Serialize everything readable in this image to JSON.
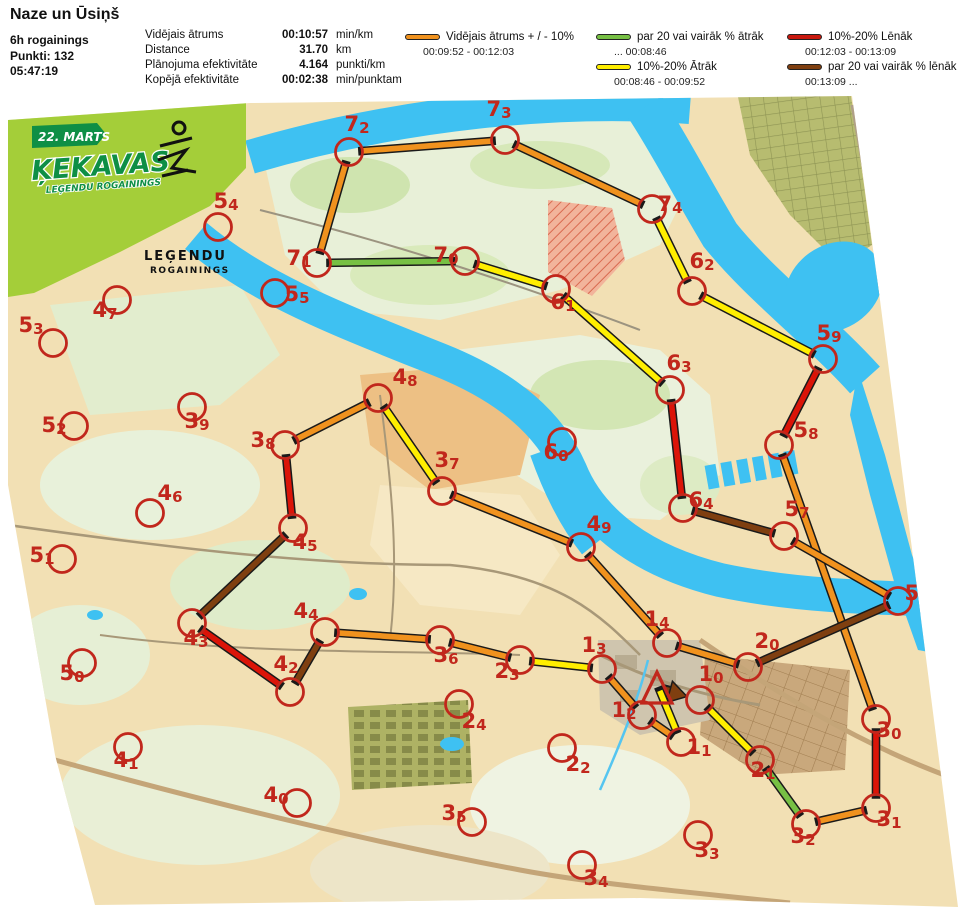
{
  "header": {
    "title": "Naze un Ūsiņš",
    "event": "6h rogainings",
    "points": "Punkti: 132",
    "time": "05:47:19",
    "stats": [
      {
        "label": "Vidējais ātrums",
        "value": "00:10:57",
        "unit": "min/km"
      },
      {
        "label": "Distance",
        "value": "31.70",
        "unit": "km"
      },
      {
        "label": "Plānojuma efektivitāte",
        "value": "4.164",
        "unit": "punkti/km"
      },
      {
        "label": "Kopējā efektivitāte",
        "value": "00:02:38",
        "unit": "min/punktam"
      }
    ]
  },
  "legend": {
    "items": [
      {
        "id": "avg",
        "label": "Vidējais ātrums + / - 10%",
        "range": "00:09:52   -   00:12:03",
        "color": "#F0921E"
      },
      {
        "id": "fast20",
        "label": "par 20 vai vairāk % ātrāk",
        "range": "...    00:08:46",
        "color": "#77C044"
      },
      {
        "id": "fast10",
        "label": "10%-20% Ātrāk",
        "range": "00:08:46   -   00:09:52",
        "color": "#FFEE00"
      },
      {
        "id": "slow10",
        "label": "10%-20% Lēnāk",
        "range": "00:12:03   - 00:13:09",
        "color": "#C8190E"
      },
      {
        "id": "slow20",
        "label": "par 20 vai vairāk % lēnāk",
        "range": "00:13:09   ...",
        "color": "#7F3F10"
      }
    ]
  },
  "logo": {
    "date": "22. MARTS",
    "name": "ĶEKAVAS",
    "sub": "LEĢENDU ROGAININGS",
    "brand1": "LEĢENDU",
    "brand2": "ROGAININGS"
  },
  "map": {
    "colors": {
      "avg": "#F0921E",
      "fast20": "#77C044",
      "fast10": "#FFEE00",
      "slow10": "#DB1408",
      "slow20": "#7F3F10"
    },
    "start": {
      "x": 659,
      "y": 689
    },
    "controls": [
      {
        "id": "10",
        "x": 700,
        "y": 700,
        "lx": 711,
        "ly": 681
      },
      {
        "id": "11",
        "x": 681,
        "y": 742,
        "lx": 699,
        "ly": 754
      },
      {
        "id": "12",
        "x": 642,
        "y": 715,
        "lx": 624,
        "ly": 717
      },
      {
        "id": "13",
        "x": 602,
        "y": 669,
        "lx": 594,
        "ly": 652
      },
      {
        "id": "14",
        "x": 667,
        "y": 643,
        "lx": 657,
        "ly": 626
      },
      {
        "id": "20",
        "x": 748,
        "y": 667,
        "lx": 767,
        "ly": 648
      },
      {
        "id": "21",
        "x": 760,
        "y": 760,
        "lx": 763,
        "ly": 777
      },
      {
        "id": "22",
        "x": 562,
        "y": 748,
        "lx": 578,
        "ly": 771
      },
      {
        "id": "23",
        "x": 520,
        "y": 660,
        "lx": 507,
        "ly": 678
      },
      {
        "id": "24",
        "x": 459,
        "y": 704,
        "lx": 474,
        "ly": 728
      },
      {
        "id": "30",
        "x": 876,
        "y": 719,
        "lx": 889,
        "ly": 737
      },
      {
        "id": "31",
        "x": 876,
        "y": 808,
        "lx": 889,
        "ly": 826
      },
      {
        "id": "32",
        "x": 806,
        "y": 824,
        "lx": 803,
        "ly": 843
      },
      {
        "id": "33",
        "x": 698,
        "y": 835,
        "lx": 707,
        "ly": 857
      },
      {
        "id": "34",
        "x": 582,
        "y": 865,
        "lx": 596,
        "ly": 885
      },
      {
        "id": "35",
        "x": 472,
        "y": 822,
        "lx": 454,
        "ly": 820
      },
      {
        "id": "36",
        "x": 440,
        "y": 640,
        "lx": 446,
        "ly": 662
      },
      {
        "id": "37",
        "x": 442,
        "y": 491,
        "lx": 447,
        "ly": 467
      },
      {
        "id": "38",
        "x": 285,
        "y": 445,
        "lx": 263,
        "ly": 447
      },
      {
        "id": "39",
        "x": 192,
        "y": 407,
        "lx": 197,
        "ly": 428
      },
      {
        "id": "40",
        "x": 297,
        "y": 803,
        "lx": 276,
        "ly": 802
      },
      {
        "id": "41",
        "x": 128,
        "y": 747,
        "lx": 126,
        "ly": 767
      },
      {
        "id": "42",
        "x": 290,
        "y": 692,
        "lx": 286,
        "ly": 671
      },
      {
        "id": "43",
        "x": 192,
        "y": 623,
        "lx": 196,
        "ly": 645
      },
      {
        "id": "44",
        "x": 325,
        "y": 632,
        "lx": 306,
        "ly": 618
      },
      {
        "id": "45",
        "x": 293,
        "y": 528,
        "lx": 305,
        "ly": 549
      },
      {
        "id": "46",
        "x": 150,
        "y": 513,
        "lx": 170,
        "ly": 500
      },
      {
        "id": "47",
        "x": 117,
        "y": 300,
        "lx": 105,
        "ly": 317
      },
      {
        "id": "48",
        "x": 378,
        "y": 398,
        "lx": 405,
        "ly": 384
      },
      {
        "id": "49",
        "x": 581,
        "y": 547,
        "lx": 599,
        "ly": 531
      },
      {
        "id": "50",
        "x": 82,
        "y": 663,
        "lx": 72,
        "ly": 680
      },
      {
        "id": "51",
        "x": 62,
        "y": 559,
        "lx": 42,
        "ly": 562
      },
      {
        "id": "52",
        "x": 74,
        "y": 426,
        "lx": 54,
        "ly": 432
      },
      {
        "id": "53",
        "x": 53,
        "y": 343,
        "lx": 31,
        "ly": 332
      },
      {
        "id": "54",
        "x": 218,
        "y": 227,
        "lx": 226,
        "ly": 208
      },
      {
        "id": "55",
        "x": 275,
        "y": 293,
        "lx": 297,
        "ly": 301
      },
      {
        "id": "56",
        "x": 898,
        "y": 601,
        "lx": 917,
        "ly": 600
      },
      {
        "id": "57",
        "x": 784,
        "y": 536,
        "lx": 797,
        "ly": 516
      },
      {
        "id": "58",
        "x": 779,
        "y": 445,
        "lx": 806,
        "ly": 437
      },
      {
        "id": "59",
        "x": 823,
        "y": 359,
        "lx": 829,
        "ly": 340
      },
      {
        "id": "60",
        "x": 562,
        "y": 442,
        "lx": 556,
        "ly": 459
      },
      {
        "id": "61",
        "x": 556,
        "y": 289,
        "lx": 563,
        "ly": 309
      },
      {
        "id": "62",
        "x": 692,
        "y": 291,
        "lx": 702,
        "ly": 268
      },
      {
        "id": "63",
        "x": 670,
        "y": 390,
        "lx": 679,
        "ly": 370
      },
      {
        "id": "64",
        "x": 683,
        "y": 508,
        "lx": 701,
        "ly": 507
      },
      {
        "id": "70",
        "x": 465,
        "y": 261,
        "lx": 446,
        "ly": 262
      },
      {
        "id": "71",
        "x": 317,
        "y": 263,
        "lx": 299,
        "ly": 265
      },
      {
        "id": "72",
        "x": 349,
        "y": 152,
        "lx": 357,
        "ly": 131
      },
      {
        "id": "73",
        "x": 505,
        "y": 140,
        "lx": 499,
        "ly": 116
      },
      {
        "id": "74",
        "x": 652,
        "y": 209,
        "lx": 670,
        "ly": 211
      }
    ],
    "route": [
      {
        "from": "start",
        "to": "10",
        "speed": "slow20",
        "arrow": true
      },
      {
        "from": "10",
        "to": "21",
        "speed": "fast10"
      },
      {
        "from": "21",
        "to": "32",
        "speed": "fast20"
      },
      {
        "from": "32",
        "to": "31",
        "speed": "avg"
      },
      {
        "from": "31",
        "to": "30",
        "speed": "slow10"
      },
      {
        "from": "30",
        "to": "58",
        "speed": "avg"
      },
      {
        "from": "58",
        "to": "59",
        "speed": "slow10"
      },
      {
        "from": "59",
        "to": "62",
        "speed": "fast10"
      },
      {
        "from": "62",
        "to": "74",
        "speed": "fast10"
      },
      {
        "from": "74",
        "to": "73",
        "speed": "avg"
      },
      {
        "from": "73",
        "to": "72",
        "speed": "avg"
      },
      {
        "from": "72",
        "to": "71",
        "speed": "avg"
      },
      {
        "from": "71",
        "to": "70",
        "speed": "fast20"
      },
      {
        "from": "70",
        "to": "61",
        "speed": "fast10"
      },
      {
        "from": "61",
        "to": "63",
        "speed": "fast10"
      },
      {
        "from": "63",
        "to": "64",
        "speed": "slow10"
      },
      {
        "from": "64",
        "to": "57",
        "speed": "slow20"
      },
      {
        "from": "57",
        "to": "56",
        "speed": "avg"
      },
      {
        "from": "56",
        "to": "20",
        "speed": "slow20"
      },
      {
        "from": "20",
        "to": "14",
        "speed": "avg"
      },
      {
        "from": "14",
        "to": "49",
        "speed": "avg"
      },
      {
        "from": "49",
        "to": "37",
        "speed": "avg"
      },
      {
        "from": "37",
        "to": "48",
        "speed": "fast10"
      },
      {
        "from": "48",
        "to": "38",
        "speed": "avg"
      },
      {
        "from": "38",
        "to": "45",
        "speed": "slow10"
      },
      {
        "from": "45",
        "to": "43",
        "speed": "slow20"
      },
      {
        "from": "43",
        "to": "42",
        "speed": "slow10"
      },
      {
        "from": "42",
        "to": "44",
        "speed": "slow20"
      },
      {
        "from": "44",
        "to": "36",
        "speed": "avg"
      },
      {
        "from": "36",
        "to": "23",
        "speed": "avg"
      },
      {
        "from": "23",
        "to": "13",
        "speed": "fast10"
      },
      {
        "from": "13",
        "to": "12",
        "speed": "avg"
      },
      {
        "from": "12",
        "to": "11",
        "speed": "avg"
      },
      {
        "from": "11",
        "to": "start",
        "speed": "fast10"
      }
    ]
  }
}
